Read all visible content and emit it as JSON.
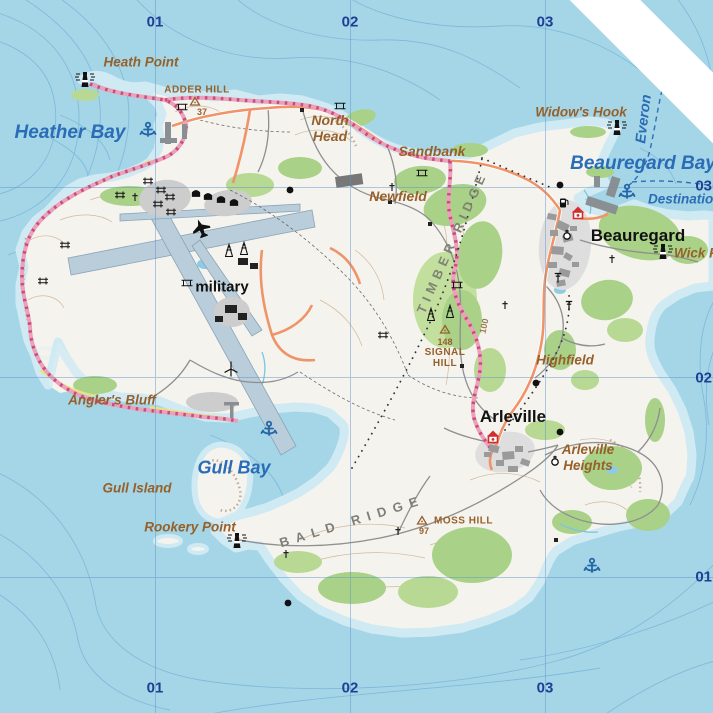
{
  "grid": {
    "top": [
      "01",
      "02",
      "03"
    ],
    "bottom": [
      "01",
      "02",
      "03"
    ],
    "right": [
      "03",
      "02",
      "01"
    ]
  },
  "water_labels": {
    "heather_bay": "Heather Bay",
    "beauregard_bay": "Beauregard Bay",
    "gull_bay": "Gull Bay",
    "everon": "Everon",
    "destination": "Destination"
  },
  "place_labels": {
    "heath_point": "Heath Point",
    "north_head": {
      "line1": "North",
      "line2": "Head"
    },
    "sandbank": "Sandbank",
    "newfield": "Newfield",
    "widows_hook": "Widow's Hook",
    "wick_point": "Wick Point",
    "highfield": "Highfield",
    "anglers_bluff": "Angler's Bluff",
    "gull_island": "Gull Island",
    "rookery_point": "Rookery Point",
    "arleville_heights": {
      "line1": "Arleville",
      "line2": "Heights"
    }
  },
  "towns": {
    "beauregard": "Beauregard",
    "arleville": "Arleville",
    "military": "military"
  },
  "ridges": {
    "timber_ridge": "TIMBER RIDGE",
    "bald_ridge": "BALD RIDGE"
  },
  "peaks": {
    "adder_hill": {
      "name": "ADDER HILL",
      "elev": "37"
    },
    "signal_hill": {
      "name": "SIGNAL HILL",
      "elev": "148"
    },
    "moss_hill": {
      "name": "MOSS HILL",
      "elev": "97"
    }
  },
  "contour_labels": {
    "depth_100": "100"
  },
  "icon_types": [
    "lighthouse-icon",
    "anchor-icon",
    "airplane-icon",
    "house-marker-icon",
    "fuel-icon",
    "chapel-icon",
    "radio-tower-icon",
    "power-tower-icon",
    "campsite-icon",
    "bridge-icon",
    "wind-turbine-icon",
    "peak-triangle-icon",
    "church-cross-icon",
    "settlement-dot-icon",
    "aircraft-shelter-icon"
  ],
  "colors": {
    "water": "#a5d6e7",
    "water_contour": "#68a9d4",
    "land": "#f5f3ee",
    "forest": "#a9d187",
    "forest_light": "#c3df9e",
    "road_orange": "#ef9469",
    "trail_pink": "#e9a3b9",
    "trail_pink_dash": "#d0487f",
    "runway": "#b9cdda",
    "water_label": "#2a6cb5",
    "place_label": "#96602b",
    "grid_label": "#1d3f94",
    "town_label": "#111111",
    "ridge_label": "#7f8474",
    "building_gray": "#9a9a9a"
  }
}
